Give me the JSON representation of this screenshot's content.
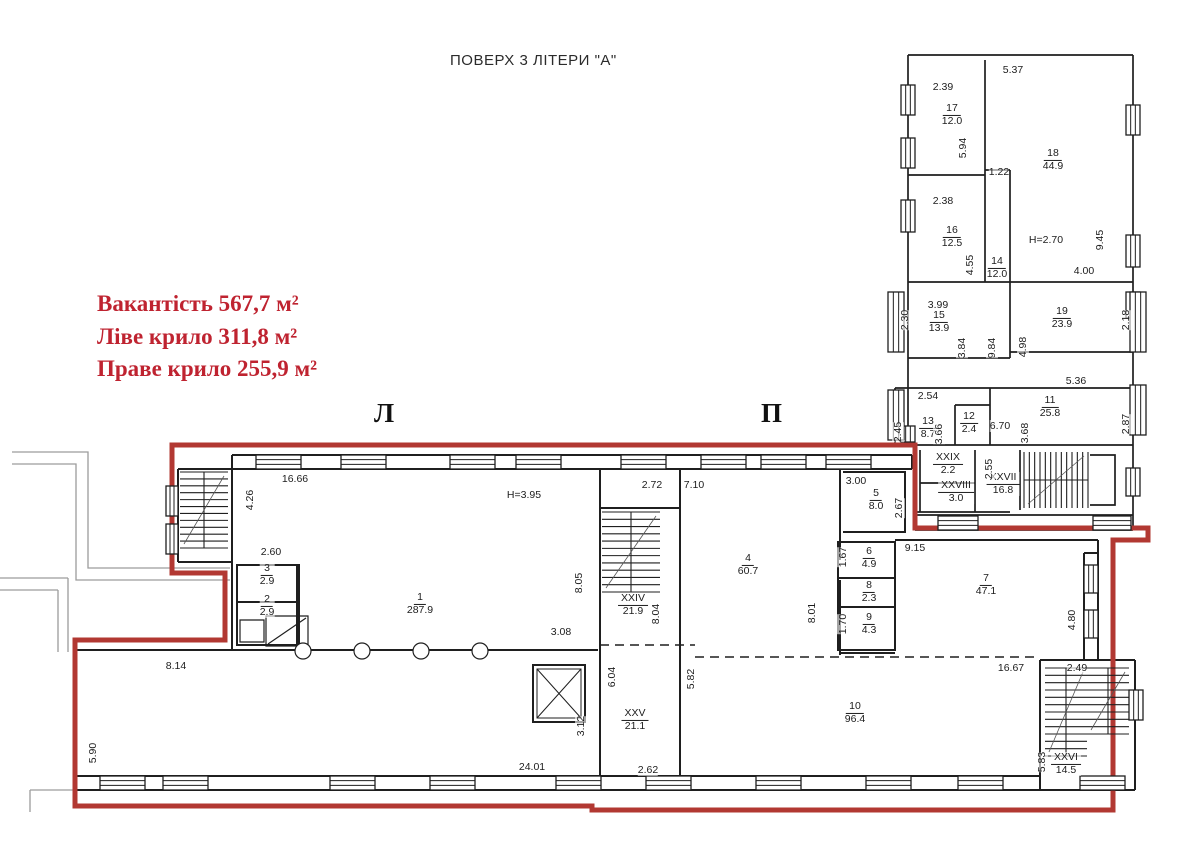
{
  "title": "ПОВЕРХ 3 ЛІТЕРИ \"А\"",
  "stats": {
    "line1": "Вакантість 567,7 м²",
    "line2": "Ліве крило 311,8 м²",
    "line3": "Праве крило 255,9 м²"
  },
  "wings": {
    "left": "Л",
    "right": "П"
  },
  "colors": {
    "outline_red": "#b23832",
    "stats_red": "#bf2330",
    "walls": "#1f1f1f",
    "exterior_gray": "#9c9c9c"
  },
  "rooms": [
    {
      "id": "1",
      "num": "1",
      "area": "287.9",
      "x": 420,
      "y": 604
    },
    {
      "id": "2",
      "num": "2",
      "area": "2.9",
      "x": 267,
      "y": 606
    },
    {
      "id": "3",
      "num": "3",
      "area": "2.9",
      "x": 267,
      "y": 575
    },
    {
      "id": "4",
      "num": "4",
      "area": "60.7",
      "x": 748,
      "y": 565
    },
    {
      "id": "5",
      "num": "5",
      "area": "8.0",
      "x": 876,
      "y": 500
    },
    {
      "id": "6",
      "num": "6",
      "area": "4.9",
      "x": 869,
      "y": 558
    },
    {
      "id": "7",
      "num": "7",
      "area": "47.1",
      "x": 986,
      "y": 585
    },
    {
      "id": "8",
      "num": "8",
      "area": "2.3",
      "x": 869,
      "y": 592
    },
    {
      "id": "9",
      "num": "9",
      "area": "4.3",
      "x": 869,
      "y": 624
    },
    {
      "id": "10",
      "num": "10",
      "area": "96.4",
      "x": 855,
      "y": 713
    },
    {
      "id": "11",
      "num": "11",
      "area": "25.8",
      "x": 1050,
      "y": 407
    },
    {
      "id": "12",
      "num": "12",
      "area": "2.4",
      "x": 969,
      "y": 423
    },
    {
      "id": "13",
      "num": "13",
      "area": "8.7",
      "x": 928,
      "y": 428
    },
    {
      "id": "14",
      "num": "14",
      "area": "12.0",
      "x": 997,
      "y": 268
    },
    {
      "id": "15",
      "num": "15",
      "area": "13.9",
      "x": 939,
      "y": 322
    },
    {
      "id": "16",
      "num": "16",
      "area": "12.5",
      "x": 952,
      "y": 237
    },
    {
      "id": "17",
      "num": "17",
      "area": "12.0",
      "x": 952,
      "y": 115
    },
    {
      "id": "18",
      "num": "18",
      "area": "44.9",
      "x": 1053,
      "y": 160
    },
    {
      "id": "19",
      "num": "19",
      "area": "23.9",
      "x": 1062,
      "y": 318
    },
    {
      "id": "XXIV",
      "num": "XXIV",
      "area": "21.9",
      "x": 633,
      "y": 605
    },
    {
      "id": "XXV",
      "num": "XXV",
      "area": "21.1",
      "x": 635,
      "y": 720
    },
    {
      "id": "XXVI",
      "num": "XXVI",
      "area": "14.5",
      "x": 1066,
      "y": 764
    },
    {
      "id": "XXVII",
      "num": "XXVII",
      "area": "16.8",
      "x": 1003,
      "y": 484
    },
    {
      "id": "XXVIII",
      "num": "XXVIII",
      "area": "3.0",
      "x": 956,
      "y": 492
    },
    {
      "id": "XXIX",
      "num": "XXIX",
      "area": "2.2",
      "x": 948,
      "y": 464
    }
  ],
  "dims": [
    {
      "t": "16.66",
      "x": 295,
      "y": 479
    },
    {
      "t": "4.26",
      "x": 250,
      "y": 500,
      "v": true
    },
    {
      "t": "2.60",
      "x": 271,
      "y": 552
    },
    {
      "t": "H=3.95",
      "x": 524,
      "y": 495
    },
    {
      "t": "2.72",
      "x": 652,
      "y": 485
    },
    {
      "t": "7.10",
      "x": 694,
      "y": 485
    },
    {
      "t": "8.05",
      "x": 579,
      "y": 583,
      "v": true
    },
    {
      "t": "8.04",
      "x": 656,
      "y": 614,
      "v": true
    },
    {
      "t": "3.08",
      "x": 561,
      "y": 632
    },
    {
      "t": "6.04",
      "x": 612,
      "y": 677,
      "v": true
    },
    {
      "t": "3.12",
      "x": 581,
      "y": 726,
      "v": true
    },
    {
      "t": "5.82",
      "x": 691,
      "y": 679,
      "v": true
    },
    {
      "t": "2.62",
      "x": 648,
      "y": 770
    },
    {
      "t": "24.01",
      "x": 532,
      "y": 767
    },
    {
      "t": "8.14",
      "x": 176,
      "y": 666
    },
    {
      "t": "5.90",
      "x": 93,
      "y": 753,
      "v": true
    },
    {
      "t": "3.00",
      "x": 856,
      "y": 481
    },
    {
      "t": "2.67",
      "x": 899,
      "y": 508,
      "v": true
    },
    {
      "t": "9.15",
      "x": 915,
      "y": 548
    },
    {
      "t": "1.67",
      "x": 843,
      "y": 557,
      "v": true
    },
    {
      "t": "1.70",
      "x": 843,
      "y": 624,
      "v": true
    },
    {
      "t": "8.01",
      "x": 812,
      "y": 613,
      "v": true
    },
    {
      "t": "4.80",
      "x": 1072,
      "y": 620,
      "v": true
    },
    {
      "t": "16.67",
      "x": 1011,
      "y": 668
    },
    {
      "t": "2.49",
      "x": 1077,
      "y": 668
    },
    {
      "t": "5.83",
      "x": 1042,
      "y": 762,
      "v": true
    },
    {
      "t": "2.39",
      "x": 943,
      "y": 87
    },
    {
      "t": "5.37",
      "x": 1013,
      "y": 70
    },
    {
      "t": "5.94",
      "x": 963,
      "y": 148,
      "v": true
    },
    {
      "t": "1.22",
      "x": 999,
      "y": 172
    },
    {
      "t": "2.38",
      "x": 943,
      "y": 201
    },
    {
      "t": "H=2.70",
      "x": 1046,
      "y": 240
    },
    {
      "t": "9.45",
      "x": 1100,
      "y": 240,
      "v": true
    },
    {
      "t": "4.55",
      "x": 970,
      "y": 265,
      "v": true
    },
    {
      "t": "4.00",
      "x": 1084,
      "y": 271
    },
    {
      "t": "3.99",
      "x": 938,
      "y": 305
    },
    {
      "t": "2.30",
      "x": 905,
      "y": 320,
      "v": true
    },
    {
      "t": "2.18",
      "x": 1126,
      "y": 320,
      "v": true
    },
    {
      "t": "3.84",
      "x": 962,
      "y": 348,
      "v": true
    },
    {
      "t": "9.84",
      "x": 992,
      "y": 348,
      "v": true
    },
    {
      "t": "4.98",
      "x": 1023,
      "y": 347,
      "v": true
    },
    {
      "t": "5.36",
      "x": 1076,
      "y": 381
    },
    {
      "t": "2.54",
      "x": 928,
      "y": 396
    },
    {
      "t": "2.45",
      "x": 898,
      "y": 432,
      "v": true
    },
    {
      "t": "3.66",
      "x": 939,
      "y": 434,
      "v": true
    },
    {
      "t": "6.70",
      "x": 1000,
      "y": 426
    },
    {
      "t": "3.68",
      "x": 1025,
      "y": 433,
      "v": true
    },
    {
      "t": "2.87",
      "x": 1126,
      "y": 424,
      "v": true
    },
    {
      "t": "2.55",
      "x": 989,
      "y": 469,
      "v": true
    }
  ]
}
